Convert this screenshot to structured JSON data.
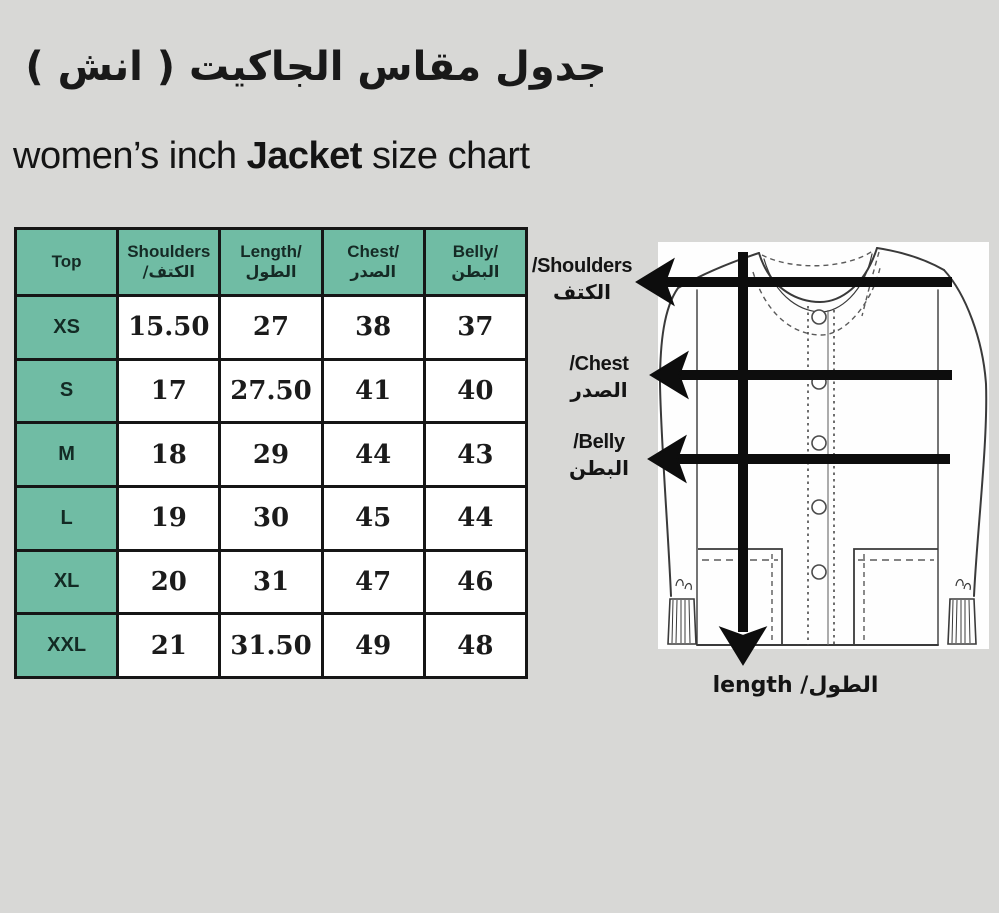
{
  "titles": {
    "arabic": "جدول مقاس الجاكيت ( انش )",
    "english_prefix": "women’s inch ",
    "english_bold": "Jacket",
    "english_suffix": " size chart"
  },
  "table": {
    "headers": [
      {
        "en": "Top",
        "ar": ""
      },
      {
        "en": "Shoulders",
        "ar": "الكتف/"
      },
      {
        "en": "Length/",
        "ar": "الطول"
      },
      {
        "en": "Chest/",
        "ar": "الصدر"
      },
      {
        "en": "Belly/",
        "ar": "البطن"
      }
    ],
    "rows": [
      {
        "size": "XS",
        "shoulders": "15.50",
        "length": "27",
        "chest": "38",
        "belly": "37"
      },
      {
        "size": "S",
        "shoulders": "17",
        "length": "27.50",
        "chest": "41",
        "belly": "40"
      },
      {
        "size": "M",
        "shoulders": "18",
        "length": "29",
        "chest": "44",
        "belly": "43"
      },
      {
        "size": "L",
        "shoulders": "19",
        "length": "30",
        "chest": "45",
        "belly": "44"
      },
      {
        "size": "XL",
        "shoulders": "20",
        "length": "31",
        "chest": "47",
        "belly": "46"
      },
      {
        "size": "XXL",
        "shoulders": "21",
        "length": "31.50",
        "chest": "49",
        "belly": "48"
      }
    ]
  },
  "diagram": {
    "shoulders_en": "/Shoulders",
    "shoulders_ar": "الكتف",
    "chest_en": "/Chest",
    "chest_ar": "الصدر",
    "belly_en": "/Belly",
    "belly_ar": "البطن",
    "length_label": "length /الطول"
  },
  "colors": {
    "background": "#d8d8d6",
    "table_teal": "#70bca4",
    "table_border": "#161616",
    "arrow_black": "#0d0d0d"
  },
  "chart_data": {
    "type": "table",
    "title": "women’s inch Jacket size chart",
    "title_ar": "جدول مقاس الجاكيت ( انش )",
    "unit": "inch",
    "columns": [
      "Top",
      "Shoulders/الكتف",
      "Length/الطول",
      "Chest/الصدر",
      "Belly/البطن"
    ],
    "rows": [
      [
        "XS",
        15.5,
        27,
        38,
        37
      ],
      [
        "S",
        17,
        27.5,
        41,
        40
      ],
      [
        "M",
        18,
        29,
        44,
        43
      ],
      [
        "L",
        19,
        30,
        45,
        44
      ],
      [
        "XL",
        20,
        31,
        47,
        46
      ],
      [
        "XXL",
        21,
        31.5,
        49,
        48
      ]
    ]
  }
}
